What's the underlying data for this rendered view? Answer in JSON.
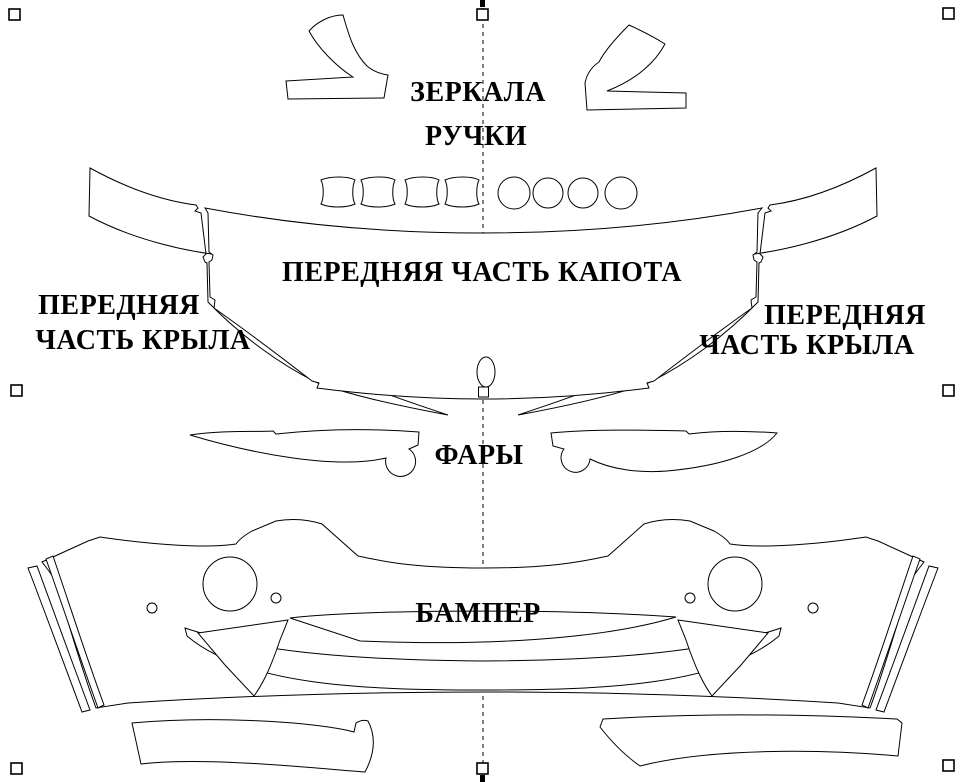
{
  "canvas": {
    "background": "#ffffff",
    "stroke_color": "#000000",
    "guide_color": "#000000"
  },
  "labels": {
    "mirrors": "ЗЕРКАЛА",
    "handles": "РУЧКИ",
    "hood": "ПЕРЕДНЯЯ ЧАСТЬ КАПОТА",
    "fender_line1": "ПЕРЕДНЯЯ",
    "fender_line2": "ЧАСТЬ КРЫЛА",
    "headlights": "ФАРЫ",
    "bumper": "БАМПЕР"
  },
  "editor": {
    "selection_handles_visible": 8,
    "guide_orientation": "vertical",
    "guide_style": "dashed"
  }
}
